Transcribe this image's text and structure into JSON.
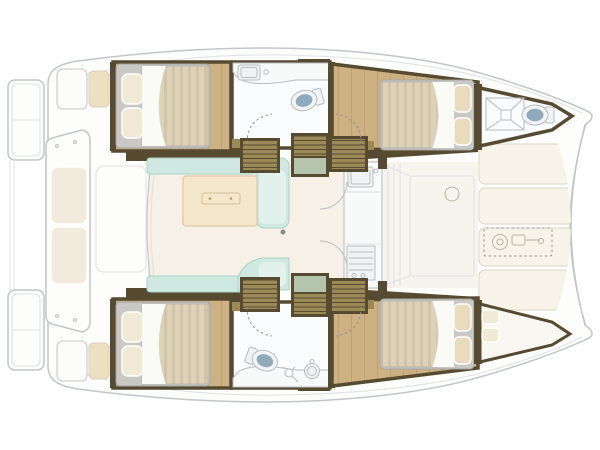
{
  "title": "Catamaran interior layout plan — top view, bow to the right",
  "palette": {
    "wall": "#564a30",
    "wood": "#cdb183",
    "wood-line": "#bda172",
    "mattress": "#ddd1b8",
    "mattress-stripe": "#d1c4a7",
    "duvet": "#fafaf7",
    "crease": "#d8d4c8",
    "pillow": "#f0e9d6",
    "pillow-fwd": "#e9dcbe",
    "bedframe": "#c8c8c5",
    "bedframe-edge": "#a5a5a2",
    "teal": "#cfe9e2",
    "teal-edge": "#a9d2c7",
    "teal-bright": "#e1f2ec",
    "table": "#f5e7cc",
    "table-edge": "#ddc9a2",
    "saloon-floor": "#f7f0e7",
    "fwd-floor": "#f6f4ed",
    "steps": "#9b8956",
    "steps-line": "#564a30",
    "landing": "#b5c4ad",
    "toilet": "#8fa9bd",
    "porcelain": "#f2f4f5",
    "fixture-line": "#b6bcbf",
    "deck-line": "#c2c6c8",
    "deck-line-light": "#dfe2e4",
    "white": "#fdfdfc",
    "bath-floor": "#fbfcfd",
    "cushion": "#f2ebdb",
    "cushion-beige": "#ecdfc2",
    "sunpad": "#f7f3e8",
    "sunpad-edge": "#dcd7c5",
    "sketch": "#b8b3a2",
    "dash": "#8f959a"
  },
  "vessel": {
    "type": "catamaran",
    "view": "top-down interior floor plan, bow pointing right",
    "port_hull_rooms": [
      "aft-double-cabin",
      "bathroom-with-toilet-and-sink",
      "companionway-steps",
      "forward-double-cabin",
      "bow-head-with-toilet-and-hatch"
    ],
    "starboard_hull_rooms": [
      "aft-double-cabin",
      "bathroom-with-toilet-sink-shower",
      "companionway-steps",
      "forward-double-cabin",
      "forepeak-berth"
    ],
    "bridgedeck": [
      "aft-cockpit",
      "saloon-u-settee",
      "saloon-table",
      "galley-sink",
      "galley-stove",
      "forward-passage-door",
      "forward-cockpit",
      "foredeck-sunpads",
      "anchor-windlass"
    ],
    "stern": [
      "transom-platforms",
      "cockpit-bench-two-cushions",
      "helm-seat-port",
      "helm-seat-starboard"
    ]
  },
  "counts": {
    "double_beds": 4,
    "single_berths": 1,
    "toilets": 3,
    "sinks": 3,
    "stoves": 1,
    "saloon_tables": 1,
    "companionways": 2
  }
}
